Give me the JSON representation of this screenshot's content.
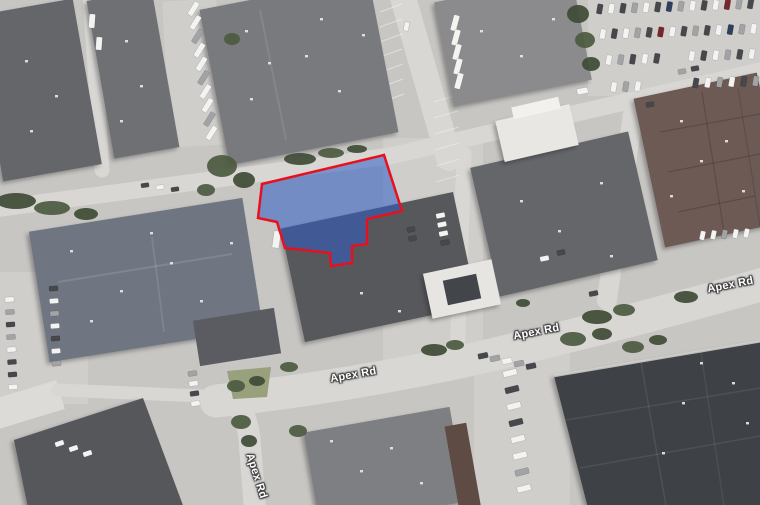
{
  "meta": {
    "view_type": "satellite-imagery",
    "highlighted_feature": "property parcel on Apex Rd"
  },
  "road_labels": [
    {
      "text": "Apex Rd"
    },
    {
      "text": "Apex Rd"
    },
    {
      "text": "Apex Rd"
    },
    {
      "text": "Apex Rd"
    }
  ],
  "parcel": {
    "points": "262,184 384,155 402,211 367,219 367,244 352,246 352,263 331,266 330,253 285,248 277,222 258,218",
    "fill": "rgba(47,92,197,0.55)",
    "stroke": "#e8101e",
    "stroke_width": "2.5"
  },
  "palette": {
    "base": "#c7c6c3",
    "road": "#d8d7d4",
    "apron": "#cfcecb",
    "apron_bright": "#dcdbd8",
    "green1": "#3f4b35",
    "green2": "#4c5a40",
    "grass": "#98a07c",
    "vent": "#eceae6",
    "stripe": "#ffffff"
  },
  "scene": {
    "aprons": [
      [
        383,
        138,
        100,
        230,
        0,
        "apron"
      ],
      [
        588,
        0,
        174,
        96,
        0,
        "apron"
      ],
      [
        0,
        272,
        88,
        132,
        0,
        "apron"
      ],
      [
        474,
        350,
        96,
        158,
        0,
        "apron"
      ],
      [
        -10,
        390,
        72,
        30,
        -17,
        "apron_bright"
      ],
      [
        166,
        0,
        54,
        146,
        -3,
        "apron"
      ]
    ],
    "roads": [
      [
        "M402,-6 L449,158",
        26
      ],
      [
        "M-6,209 L390,156 L764,70",
        17
      ],
      [
        "M216,401 Q330,389 460,362 Q610,328 764,284",
        33
      ],
      [
        "M220,397 Q248,402 250,446 L255,510",
        22
      ],
      [
        "M633,114 L607,300",
        20
      ],
      [
        "M464,154 L457,362",
        15
      ],
      [
        "M90,-4 L102,170",
        15
      ],
      [
        "M58,390 L226,397",
        13
      ]
    ],
    "stripe_lines": [
      [
        380,
        12,
        402,
        4,
        0.45
      ],
      [
        380,
        27,
        402,
        19,
        0.45
      ],
      [
        380,
        42,
        402,
        34,
        0.45
      ],
      [
        380,
        57,
        402,
        49,
        0.45
      ],
      [
        381,
        72,
        403,
        64,
        0.45
      ],
      [
        381,
        87,
        403,
        79,
        0.45
      ],
      [
        382,
        102,
        404,
        94,
        0.45
      ],
      [
        434,
        102,
        458,
        95,
        0.35
      ],
      [
        434,
        118,
        458,
        111,
        0.35
      ],
      [
        435,
        134,
        459,
        127,
        0.35
      ],
      [
        435,
        150,
        459,
        143,
        0.35
      ],
      [
        436,
        166,
        460,
        159,
        0.35
      ],
      [
        436,
        182,
        460,
        175,
        0.35
      ]
    ],
    "grass_island": "227,371 271,367 267,397 233,399",
    "buildings": [
      {
        "t": "r",
        "x": -12,
        "y": 6,
        "w": 100,
        "h": 168,
        "rot": -10,
        "f": "#646669",
        "s": 1
      },
      {
        "t": "r",
        "x": 100,
        "y": -6,
        "w": 66,
        "h": 160,
        "rot": -10,
        "f": "#6e7073",
        "s": 1
      },
      {
        "t": "r",
        "x": 213,
        "y": -8,
        "w": 172,
        "h": 158,
        "rot": -11,
        "f": "#797a7d",
        "s": 1
      },
      {
        "t": "r",
        "x": 443,
        "y": -12,
        "w": 140,
        "h": 106,
        "rot": -11,
        "f": "#8b8b8d",
        "s": 1
      },
      {
        "t": "r",
        "x": 648,
        "y": 84,
        "w": 126,
        "h": 152,
        "rot": -12,
        "f": "#6d5a55",
        "s": 1
      },
      {
        "t": "r",
        "x": 483,
        "y": 148,
        "w": 162,
        "h": 132,
        "rot": -13,
        "f": "#65666a",
        "s": 1
      },
      {
        "t": "r",
        "x": 499,
        "y": 112,
        "w": 76,
        "h": 42,
        "rot": -13,
        "f": "#e8e7e4",
        "s": 1
      },
      {
        "t": "r",
        "x": 512,
        "y": 102,
        "w": 48,
        "h": 12,
        "rot": -13,
        "f": "#f2f1ee",
        "s": 0
      },
      {
        "t": "r",
        "x": 291,
        "y": 209,
        "w": 176,
        "h": 116,
        "rot": -12,
        "f": "#57585c",
        "s": 1
      },
      {
        "t": "r",
        "x": 427,
        "y": 266,
        "w": 70,
        "h": 46,
        "rot": -12,
        "f": "#e6e5e2",
        "s": 1
      },
      {
        "t": "r",
        "x": 445,
        "y": 277,
        "w": 34,
        "h": 25,
        "rot": -12,
        "f": "#42464a",
        "s": 0
      },
      {
        "t": "r",
        "x": 38,
        "y": 214,
        "w": 216,
        "h": 132,
        "rot": -9,
        "f": "#6f7681",
        "s": 1
      },
      {
        "t": "r",
        "x": 196,
        "y": 314,
        "w": 82,
        "h": 46,
        "rot": -9,
        "f": "#5a5c61",
        "s": 0
      },
      {
        "t": "p",
        "pts": "14,440 143,398 184,508 28,508",
        "f": "#55575b",
        "s": 1
      },
      {
        "t": "r",
        "x": 311,
        "y": 419,
        "w": 148,
        "h": 96,
        "rot": -10,
        "f": "#7e7f83",
        "s": 1
      },
      {
        "t": "r",
        "x": 452,
        "y": 424,
        "w": 22,
        "h": 88,
        "rot": -10,
        "f": "#5e4b43",
        "s": 0
      },
      {
        "t": "p",
        "pts": "554,376 762,341 762,508 588,508",
        "f": "#3e4145",
        "s": 1
      }
    ],
    "roof_lines": [
      [
        660,
        132,
        760,
        114,
        "rgba(40,30,28,0.25)",
        1.2
      ],
      [
        668,
        172,
        760,
        154,
        "rgba(40,30,28,0.25)",
        1.2
      ],
      [
        678,
        212,
        755,
        196,
        "rgba(40,30,28,0.25)",
        1.2
      ],
      [
        702,
        92,
        724,
        232,
        "rgba(40,30,28,0.25)",
        1.2
      ],
      [
        738,
        88,
        760,
        226,
        "rgba(40,30,28,0.2)",
        1.2
      ],
      [
        566,
        420,
        760,
        388,
        "rgba(200,200,200,0.12)",
        1.5
      ],
      [
        580,
        468,
        760,
        436,
        "rgba(200,200,200,0.12)",
        1.5
      ],
      [
        640,
        356,
        666,
        506,
        "rgba(200,200,200,0.12)",
        1.5
      ],
      [
        700,
        346,
        724,
        506,
        "rgba(200,200,200,0.1)",
        1.5
      ],
      [
        554,
        376,
        762,
        341,
        "rgba(210,210,206,0.85)",
        2.5
      ],
      [
        58,
        282,
        232,
        254,
        "rgba(255,255,255,0.12)",
        2
      ],
      [
        152,
        237,
        164,
        332,
        "rgba(255,255,255,0.1)",
        2
      ],
      [
        260,
        10,
        286,
        140,
        "rgba(255,255,255,0.09)",
        2
      ]
    ],
    "trees": [
      [
        16,
        201,
        20,
        8
      ],
      [
        52,
        208,
        18,
        7
      ],
      [
        86,
        214,
        12,
        6
      ],
      [
        222,
        166,
        15,
        11
      ],
      [
        244,
        180,
        11,
        8
      ],
      [
        206,
        190,
        9,
        6
      ],
      [
        300,
        159,
        16,
        6
      ],
      [
        331,
        153,
        13,
        5
      ],
      [
        357,
        149,
        10,
        4
      ],
      [
        232,
        39,
        8,
        6
      ],
      [
        578,
        14,
        11,
        9
      ],
      [
        585,
        40,
        10,
        8
      ],
      [
        591,
        64,
        9,
        7
      ],
      [
        289,
        367,
        9,
        5
      ],
      [
        434,
        350,
        13,
        6
      ],
      [
        455,
        345,
        9,
        5
      ],
      [
        597,
        317,
        15,
        7
      ],
      [
        624,
        310,
        11,
        6
      ],
      [
        686,
        297,
        12,
        6
      ],
      [
        573,
        339,
        13,
        7
      ],
      [
        602,
        334,
        10,
        6
      ],
      [
        633,
        347,
        11,
        6
      ],
      [
        658,
        340,
        9,
        5
      ],
      [
        236,
        386,
        9,
        6
      ],
      [
        257,
        381,
        8,
        5
      ],
      [
        241,
        422,
        10,
        7
      ],
      [
        249,
        441,
        8,
        6
      ],
      [
        298,
        431,
        9,
        6
      ],
      [
        523,
        303,
        7,
        4
      ]
    ],
    "vents": [
      [
        25,
        60
      ],
      [
        55,
        95
      ],
      [
        30,
        130
      ],
      [
        125,
        40
      ],
      [
        140,
        85
      ],
      [
        120,
        120
      ],
      [
        245,
        30
      ],
      [
        268,
        62
      ],
      [
        250,
        98
      ],
      [
        305,
        55
      ],
      [
        338,
        90
      ],
      [
        362,
        34
      ],
      [
        320,
        18
      ],
      [
        480,
        30
      ],
      [
        520,
        55
      ],
      [
        552,
        18
      ],
      [
        520,
        200
      ],
      [
        558,
        230
      ],
      [
        600,
        182
      ],
      [
        610,
        255
      ],
      [
        360,
        292
      ],
      [
        398,
        310
      ],
      [
        70,
        250
      ],
      [
        120,
        290
      ],
      [
        90,
        320
      ],
      [
        170,
        262
      ],
      [
        200,
        300
      ],
      [
        230,
        242
      ],
      [
        150,
        232
      ],
      [
        330,
        440
      ],
      [
        360,
        470
      ],
      [
        390,
        447
      ],
      [
        420,
        482
      ],
      [
        680,
        120
      ],
      [
        700,
        160
      ],
      [
        670,
        195
      ],
      [
        725,
        140
      ],
      [
        742,
        190
      ],
      [
        700,
        362
      ],
      [
        732,
        382
      ],
      [
        682,
        402
      ],
      [
        746,
        422
      ],
      [
        662,
        452
      ]
    ],
    "car_colors": [
      "#f3f3f1",
      "#a2a3a5",
      "#46484c",
      "#77262c",
      "#2f3f5c"
    ],
    "car_rows": [
      {
        "x": 597,
        "y": 4,
        "dx": 11.6,
        "dy": -0.4,
        "n": 14,
        "w": 5.5,
        "h": 10,
        "r": 10,
        "c": "20210241020312"
      },
      {
        "x": 600,
        "y": 29,
        "dx": 11.6,
        "dy": -0.4,
        "n": 14,
        "w": 5.5,
        "h": 10,
        "r": 10,
        "c": "02012302120410"
      },
      {
        "x": 606,
        "y": 55,
        "dx": 12,
        "dy": -0.4,
        "n": 5,
        "w": 5.5,
        "h": 10,
        "r": 10,
        "c": "01202"
      },
      {
        "x": 689,
        "y": 51,
        "dx": 12,
        "dy": -0.4,
        "n": 6,
        "w": 5.5,
        "h": 10,
        "r": 10,
        "c": "020120"
      },
      {
        "x": 693,
        "y": 78,
        "dx": 12,
        "dy": -0.4,
        "n": 6,
        "w": 5.5,
        "h": 10,
        "r": 10,
        "c": "201021"
      },
      {
        "x": 611,
        "y": 82,
        "dx": 12,
        "dy": -0.4,
        "n": 3,
        "w": 5.5,
        "h": 10,
        "r": 10,
        "c": "010"
      },
      {
        "x": 700,
        "y": 231,
        "dx": 11,
        "dy": -0.6,
        "n": 5,
        "w": 5,
        "h": 9,
        "r": 12,
        "c": "00100"
      },
      {
        "x": 186,
        "y": 6,
        "dx": 2,
        "dy": 13.8,
        "n": 10,
        "w": 15,
        "h": 5.5,
        "r": -58,
        "c": "0010010010"
      },
      {
        "x": 447,
        "y": 20,
        "dx": 1,
        "dy": 14.5,
        "n": 5,
        "w": 16,
        "h": 6,
        "r": -75,
        "c": "00000"
      },
      {
        "x": 5,
        "y": 297,
        "dx": 0.5,
        "dy": 12.5,
        "n": 8,
        "w": 9,
        "h": 5,
        "r": -4,
        "c": "01210220"
      },
      {
        "x": 49,
        "y": 286,
        "dx": 0.5,
        "dy": 12.5,
        "n": 7,
        "w": 9,
        "h": 5,
        "r": -4,
        "c": "2010201"
      },
      {
        "x": 436,
        "y": 213,
        "dx": 1.5,
        "dy": 9,
        "n": 4,
        "w": 9,
        "h": 5,
        "r": -12,
        "c": "0002"
      },
      {
        "x": 407,
        "y": 227,
        "dx": 1.5,
        "dy": 9,
        "n": 2,
        "w": 8,
        "h": 5,
        "r": -12,
        "c": "22"
      },
      {
        "x": 188,
        "y": 371,
        "dx": 1,
        "dy": 10,
        "n": 4,
        "w": 9,
        "h": 5,
        "r": -8,
        "c": "1020"
      },
      {
        "x": 141,
        "y": 183,
        "dx": 15,
        "dy": 2,
        "n": 3,
        "w": 8,
        "h": 4.5,
        "r": -8,
        "c": "202"
      },
      {
        "x": 478,
        "y": 353,
        "dx": 12,
        "dy": 2.6,
        "n": 5,
        "w": 10,
        "h": 5.5,
        "r": -12,
        "c": "21012"
      },
      {
        "x": 503,
        "y": 370,
        "dx": 2,
        "dy": 16.5,
        "n": 8,
        "w": 14,
        "h": 6,
        "r": -14,
        "c": "02020010"
      },
      {
        "x": 55,
        "y": 441,
        "dx": 14,
        "dy": 5,
        "n": 3,
        "w": 9,
        "h": 5,
        "r": -18,
        "c": "000"
      }
    ],
    "cars": [
      [
        577,
        88,
        11,
        6,
        -10,
        0
      ],
      [
        646,
        102,
        8,
        5,
        -10,
        2
      ],
      [
        678,
        69,
        8,
        5,
        -10,
        1
      ],
      [
        691,
        66,
        8,
        5,
        -10,
        2
      ],
      [
        540,
        256,
        9,
        5,
        -12,
        0
      ],
      [
        557,
        250,
        8,
        5,
        -12,
        2
      ],
      [
        89,
        14,
        6,
        14,
        4,
        0
      ],
      [
        96,
        37,
        6,
        13,
        4,
        0
      ],
      [
        404,
        22,
        5,
        9,
        10,
        0
      ],
      [
        589,
        291,
        9,
        5,
        -11,
        2
      ],
      [
        273,
        231,
        7,
        17,
        8,
        0
      ]
    ]
  }
}
